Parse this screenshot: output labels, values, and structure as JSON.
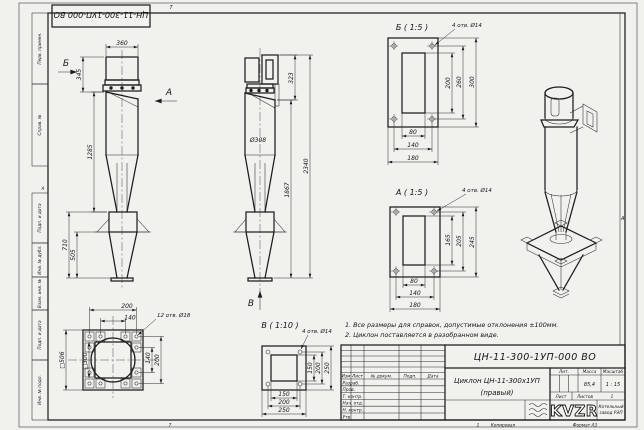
{
  "sheet": {
    "stamp_rotated": "ЦН-11-300-1УП-000 ВО",
    "zone_letter": "А",
    "fold_mark_top": "7",
    "fold_mark_bottom": "7",
    "bottom_num": "1",
    "copied_by": "Копировал",
    "format": "Формат А3",
    "side_labels": [
      "Перв. примен.",
      "Справ. №",
      "Подп. и дата",
      "Инв. № дубл.",
      "Взам. инв. №",
      "Подп. и дата",
      "Инв. № подл."
    ]
  },
  "views": {
    "front": {
      "arrow_b": "Б",
      "arrow_a": "А",
      "dim_360": "360",
      "dim_345": "345",
      "dim_1285": "1285",
      "dim_710": "710",
      "dim_505": "505"
    },
    "side": {
      "dim_323": "323",
      "dim_d308": "Ø308",
      "dim_1867": "1867",
      "dim_2340": "2340",
      "arrow_v": "В"
    },
    "detail_b": {
      "title": "Б ( 1:5 )",
      "holes_note": "4 отв. Ø14",
      "dim_200": "200",
      "dim_260": "260",
      "dim_300": "300",
      "dim_80": "80",
      "dim_140": "140",
      "dim_180": "180"
    },
    "detail_a": {
      "title": "А ( 1:5 )",
      "holes_note": "4 отв. Ø14",
      "dim_165": "165",
      "dim_205": "205",
      "dim_245": "245",
      "dim_80": "80",
      "dim_140": "140",
      "dim_180": "180"
    },
    "detail_v": {
      "title": "В ( 1:10 )",
      "holes_note": "4 отв. Ø14",
      "dim_150_v": "150",
      "dim_200_v": "200",
      "dim_250_v": "250",
      "dim_150_h": "150",
      "dim_200_h": "200",
      "dim_250_h": "250"
    },
    "base_flange": {
      "holes_note": "12 отв. Ø18",
      "dim_200_top": "200",
      "dim_140_top": "140",
      "dim_140_right": "140",
      "dim_200_right": "200",
      "dim_sq506": "□506",
      "dim_sq300": "□300"
    }
  },
  "notes": {
    "line1": "1. Все размеры для справок, допустимые отклонения ±100мм.",
    "line2": "2. Циклон поставляется в разобранном виде."
  },
  "title_block": {
    "doc_number": "ЦН-11-300-1УП-000 ВО",
    "name_line1": "Циклон ЦН-11-300х1УП",
    "name_line2": "(правый)",
    "cols": {
      "izm": "Изм",
      "list": "Лист",
      "n_dokum": "№ докум.",
      "podp": "Подп.",
      "data": "Дата"
    },
    "rows": {
      "razrab": "Разраб.",
      "prov": "Пров.",
      "t_kontr": "Т. контр.",
      "nach_otd": "Нач. отд.",
      "n_kontr": "Н. контр.",
      "utv": "Утв."
    },
    "lit_label": "Лит.",
    "mass_label": "Масса",
    "mass_value": "85,4",
    "scale_label": "Масштаб",
    "scale_value": "1 : 15",
    "sheet_label": "Лист",
    "sheets_label": "Листов",
    "sheets_value": "1",
    "logo_text": "KVZR",
    "logo_caption_line1": "Котельный",
    "logo_caption_line2": "завод РЭП"
  }
}
